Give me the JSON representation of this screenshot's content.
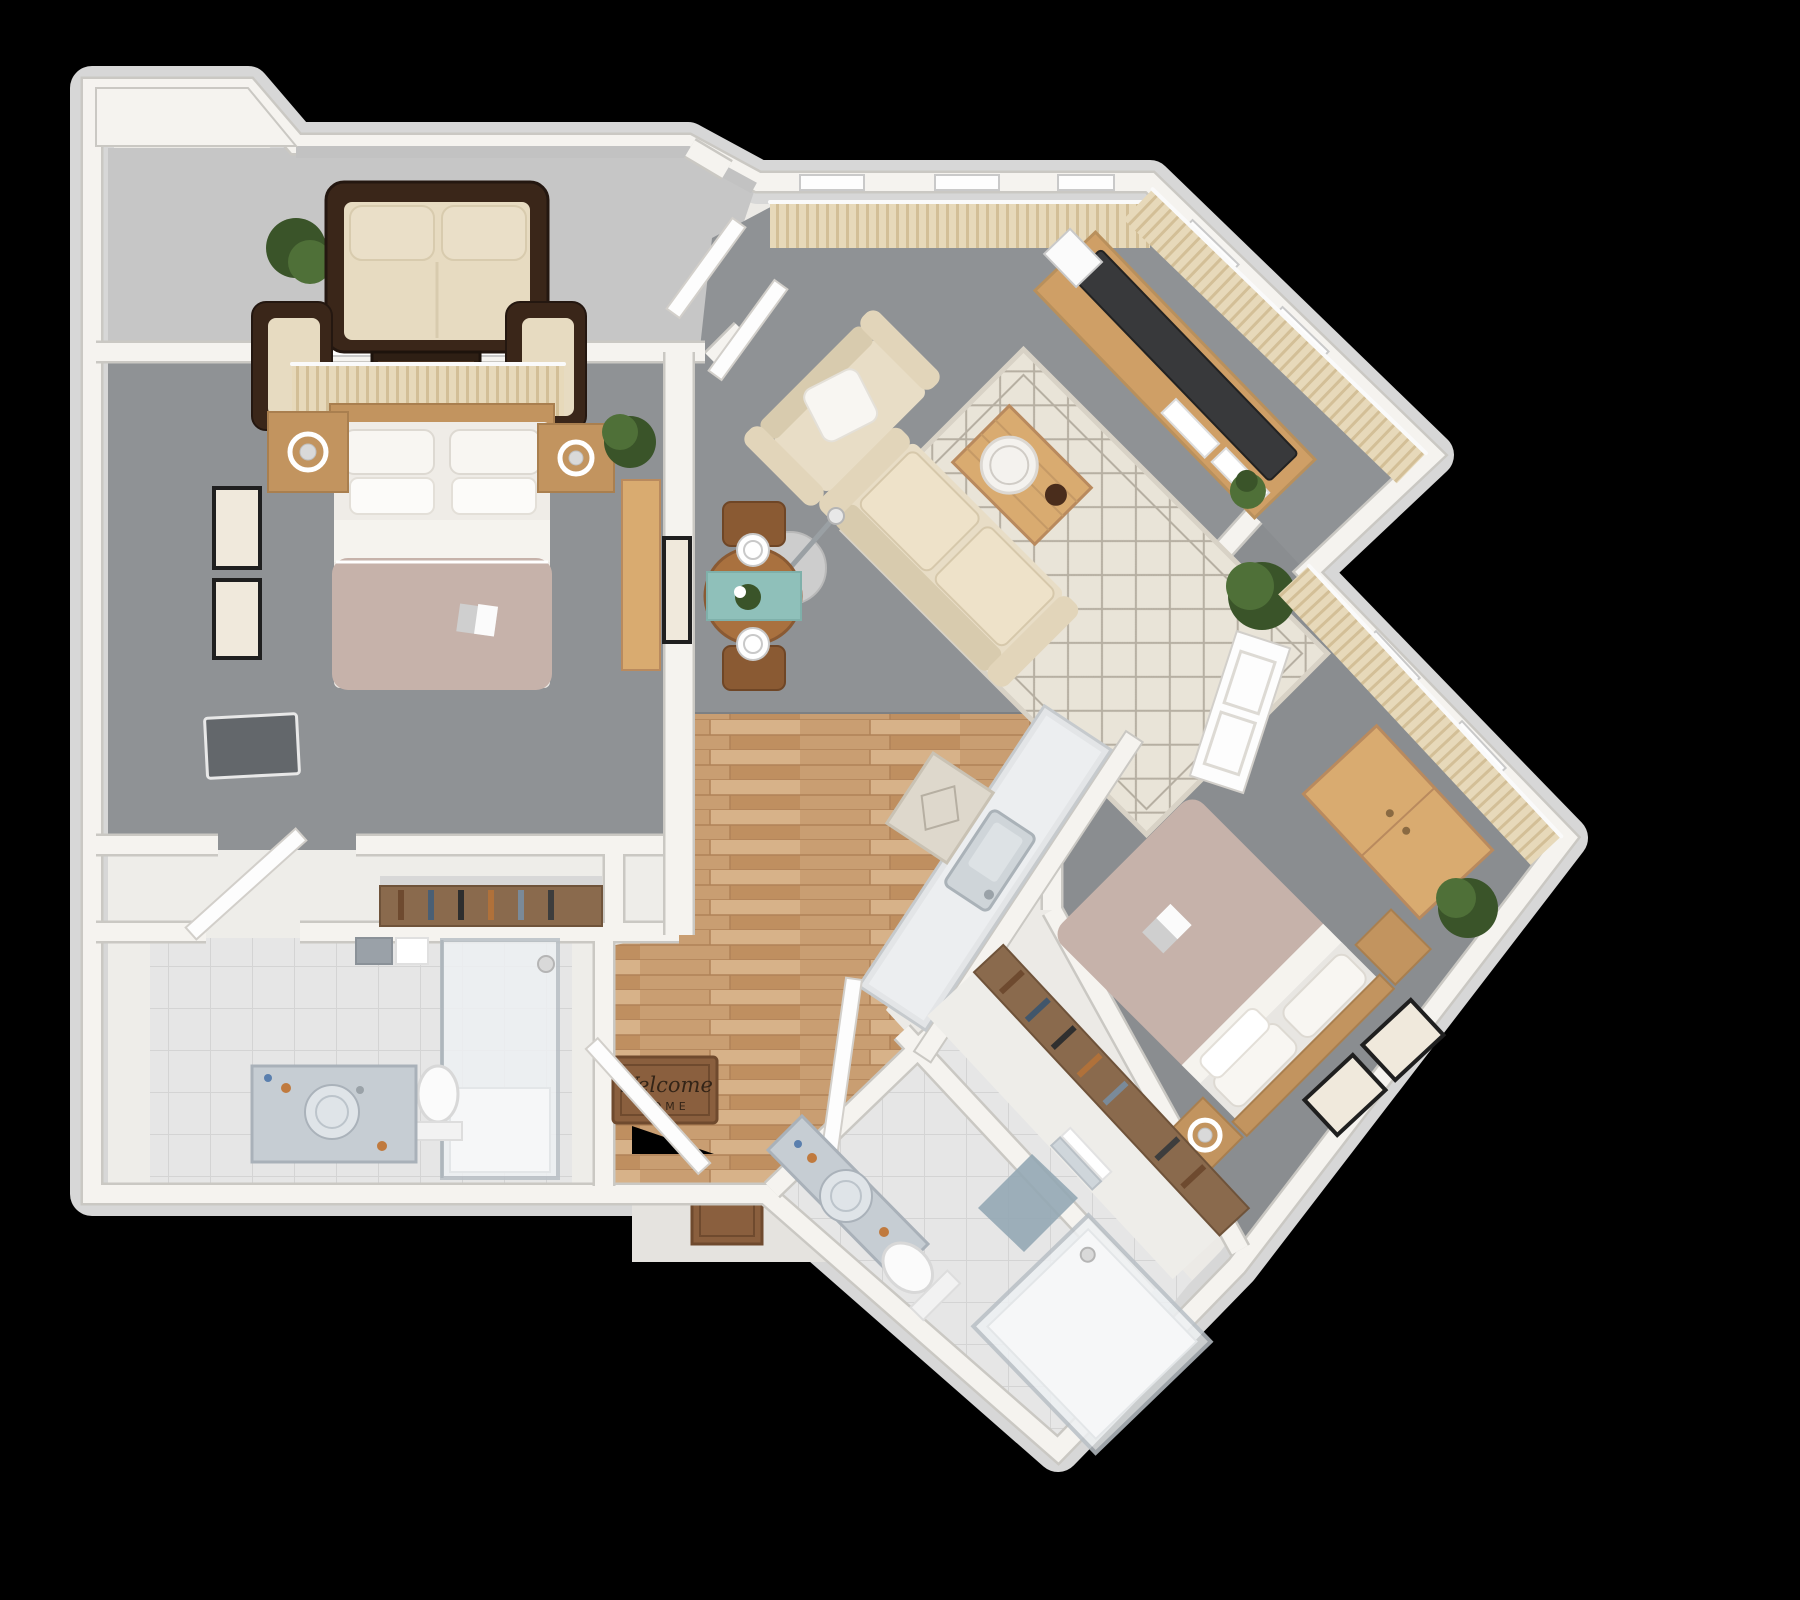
{
  "scene": {
    "kind": "3d-rendered-floor-plan-top-view",
    "background": "#000000",
    "visible_text": [
      "Welcome",
      "HOME"
    ]
  },
  "entry": {
    "mat_line1": "Welcome",
    "mat_line2": "HOME"
  },
  "palette": {
    "bg": "#000000",
    "slab": "#d7d7d7",
    "wall": "#f5f3ef",
    "wall_edge": "#cac8c3",
    "wall_fill": "#eceae6",
    "concrete": "#c6c6c6",
    "carpet": "#8f9295",
    "carpet2": "#8a8d90",
    "whitefloor": "#eeede9",
    "tile": "#e6e6e6",
    "tile_line": "#d4d4d4",
    "wood1": "#d7b289",
    "wood2": "#c99e72",
    "wood3": "#bf8f60",
    "closet_wood": "#8a6a4d",
    "wicker": "#3a2619",
    "wicker_dark": "#241710",
    "cushion": "#e7dbc1",
    "pillow": "#f8f6f2",
    "sofa_beige": "#e8ddc6",
    "sofa_shadow": "#d8cbae",
    "duvet": "#c6b2aa",
    "linen": "#f5f3ee",
    "furn_wood": "#c2945f",
    "furn_wood_light": "#d9ab70",
    "console": "#cf9f66",
    "tv_dark": "#38393b",
    "rug": "#e9e4d8",
    "rug_line": "#b6afa2",
    "curtain": "#e7d9ba",
    "curtain_line": "#d3bf97",
    "plant": "#4f7038",
    "plant_dark": "#3a5429",
    "glass": "#eef1f3",
    "glass_edge": "#b9c0c6",
    "marble": "#c6cdd3",
    "teal": "#8fc0ba",
    "mat": "#8a5f3e",
    "mat_border": "#6f4a2e",
    "mat_text": "#332417",
    "landing": "#e5e3df",
    "art_frame": "#1f1f1f",
    "art_paper": "#f0e9dc",
    "metal": "#c7c7c7"
  },
  "rooms": [
    {
      "id": "balcony",
      "label": "Balcony patio",
      "floor": "concrete",
      "furniture": [
        "wicker-sofa",
        "wicker-armchair-left",
        "wicker-armchair-right",
        "coffee-table",
        "potted-plant"
      ]
    },
    {
      "id": "master-bedroom",
      "label": "Master bedroom",
      "floor": "gray-carpet",
      "furniture": [
        "double-bed",
        "nightstand-left",
        "nightstand-right",
        "table-lamp-x2",
        "wall-art-x2",
        "wall-tv",
        "desk",
        "window-curtains",
        "potted-plant",
        "book-on-bed"
      ]
    },
    {
      "id": "master-closet",
      "label": "Closet nook",
      "floor": "white",
      "furniture": [
        "closet-rod-with-clothes",
        "bedroom-door"
      ]
    },
    {
      "id": "master-bathroom",
      "label": "Master bathroom",
      "floor": "tile",
      "furniture": [
        "vanity-with-round-sink",
        "toilet",
        "glass-shower",
        "towel-rack"
      ]
    },
    {
      "id": "living-room",
      "label": "Living room",
      "floor": "gray-carpet",
      "furniture": [
        "fabric-sofa",
        "armchair-with-pillow",
        "area-rug",
        "coffee-table-with-tray",
        "floor-lamp",
        "tv-console",
        "flat-tv",
        "magazines",
        "corner-plant",
        "window-curtains",
        "french-doors",
        "door-to-bedroom-2"
      ]
    },
    {
      "id": "dining-area",
      "label": "Dining area",
      "floor": "gray-carpet",
      "furniture": [
        "round-dining-table",
        "table-runner",
        "two-place-settings",
        "centerpiece-plant",
        "chair-top",
        "chair-bottom",
        "wall-art"
      ]
    },
    {
      "id": "kitchen",
      "label": "Kitchen / entry hall",
      "floor": "wood-planks",
      "furniture": [
        "island-counter-with-sink",
        "small-rug",
        "welcome-mat",
        "entry-door",
        "exterior-doormat"
      ]
    },
    {
      "id": "bedroom-2",
      "label": "Bedroom 2",
      "floor": "gray-carpet",
      "furniture": [
        "double-bed",
        "nightstand-x2",
        "table-lamp",
        "wardrobe-dresser",
        "wall-art-x2",
        "window-curtains",
        "potted-plant",
        "book-on-bed"
      ]
    },
    {
      "id": "hall-closet-2",
      "label": "Closet corridor",
      "floor": "white",
      "furniture": [
        "closet-rod-with-clothes",
        "corridor-door"
      ]
    },
    {
      "id": "bathroom-2",
      "label": "Bathroom 2",
      "floor": "tile",
      "furniture": [
        "vanity-with-round-sink",
        "toilet",
        "glass-shower",
        "bath-mat",
        "towels"
      ]
    }
  ]
}
